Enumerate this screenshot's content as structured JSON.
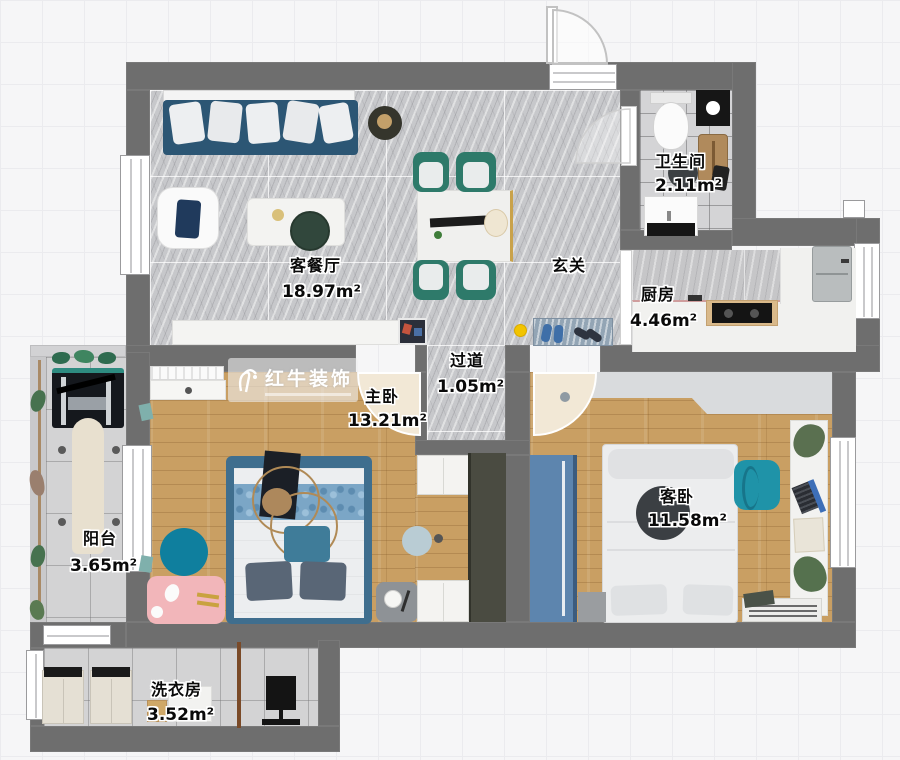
{
  "title": "两居室户型图",
  "watermark": {
    "brand": "红牛装饰"
  },
  "rooms": {
    "living": {
      "name": "客餐厅",
      "area": "18.97m²"
    },
    "entry": {
      "name": "玄关"
    },
    "bathroom": {
      "name": "卫生间",
      "area": "2.11m²"
    },
    "kitchen": {
      "name": "厨房",
      "area": "4.46m²"
    },
    "corridor": {
      "name": "过道",
      "area": "1.05m²"
    },
    "master": {
      "name": "主卧",
      "area": "13.21m²"
    },
    "guest": {
      "name": "客卧",
      "area": "11.58m²"
    },
    "balcony": {
      "name": "阳台",
      "area": "3.65m²"
    },
    "laundry": {
      "name": "洗衣房",
      "area": "3.52m²"
    }
  },
  "furniture_icons": [
    "sofa-icon",
    "armchair-icon",
    "coffee-table-icon",
    "dining-table-icon",
    "dining-chair-icon",
    "tv-cabinet-icon",
    "doormat-icon",
    "toilet-icon",
    "shower-icon",
    "vanity-sink-icon",
    "stove-icon",
    "kitchen-sink-icon",
    "double-bed-icon",
    "wardrobe-icon",
    "nightstand-icon",
    "round-rug-icon",
    "desk-laptop-icon",
    "radiator-icon",
    "treadmill-icon",
    "washing-machine-icon",
    "drying-rack-icon",
    "fan-icon",
    "plant-icon"
  ],
  "colors": {
    "wall": "#6e6e6e",
    "wood_floor": "#c99f63",
    "marble_floor": "#c7c8cb",
    "sofa_navy": "#2c5674",
    "chair_teal": "#2e7a6a",
    "bed_frame_blue": "#3f6e8e",
    "wardrobe_blue": "#5d85ae",
    "accent_teal": "#1f93a8",
    "rug_pink": "#f2b6ba",
    "marker_yellow": "#f2c400",
    "door_swing": "#f2e8d6"
  }
}
